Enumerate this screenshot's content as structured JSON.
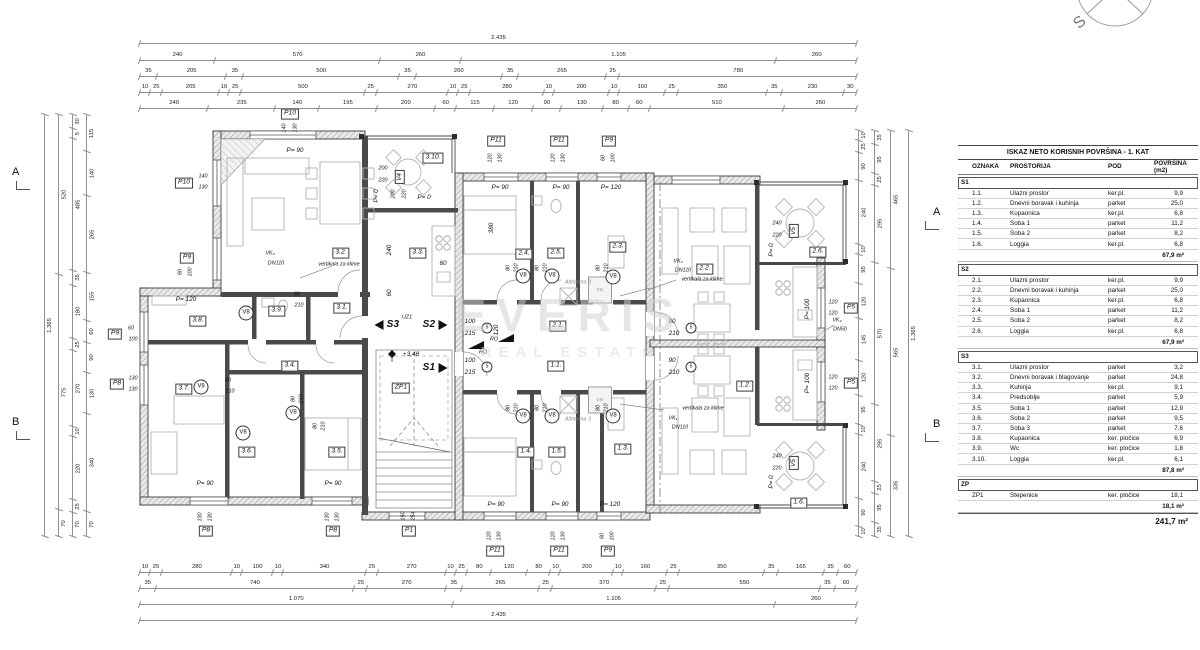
{
  "watermark": {
    "line1": "EVERIS",
    "line2": "REAL ESTATE"
  },
  "compass": {
    "north_letter": "S"
  },
  "section_markers": {
    "a": "A",
    "b": "B"
  },
  "plan": {
    "rooms": {
      "r11": "1.1.",
      "r12": "1.2.",
      "r13": "1.3.",
      "r14": "1.4.",
      "r15": "1.5.",
      "r16": "1.6.",
      "r21": "2.1.",
      "r22": "2.2.",
      "r23": "2.3.",
      "r24": "2.4.",
      "r25": "2.5.",
      "r26": "2.6.",
      "r31": "3.1.",
      "r32": "3.2.",
      "r33": "3.3.",
      "r34": "3.4.",
      "r35": "3.5.",
      "r36": "3.6.",
      "r37": "3.7.",
      "r38": "3.8.",
      "r39": "3.9.",
      "r310": "3.10.",
      "zp1": "ZP1"
    },
    "markers": {
      "p1": "P1",
      "p5": "P5",
      "p8": "P8",
      "p9": "P9",
      "p10": "P10",
      "p11": "P11"
    },
    "v": {
      "v4": "V4",
      "v5": "V5",
      "v8": "V8",
      "c5": "5"
    },
    "doors": {
      "p0": "P= 0",
      "p90": "P= 90",
      "p100": "P= 100",
      "p120": "P= 120"
    },
    "nums": {
      "n60": "60",
      "n80": "80",
      "n90": "90",
      "n100": "100",
      "n115": "115",
      "n120": "120",
      "n130": "130",
      "n140": "140",
      "n150": "150",
      "n200": "200",
      "n210": "210",
      "n215": "215",
      "n220": "220",
      "n240": "240",
      "n254": "254",
      "n380": "380"
    },
    "texts": {
      "vk1": "VK₁",
      "vk2": "VK₂",
      "vk3": "VK₃",
      "vk4": "VK₄",
      "dn110": "DN110",
      "dn50": "DN50",
      "vert": "vertikala za klime",
      "uz1": "UZ1",
      "ro": "RO",
      "level": "+3,48",
      "s1": "S1",
      "s2": "S2",
      "s3": "S3",
      "altherma": "Altherma 3",
      "pr": "PR"
    }
  },
  "dims": {
    "top": [
      [
        "2.435"
      ],
      [
        "240",
        "570",
        "260",
        "1.105",
        "260"
      ],
      [
        "35",
        "205",
        "35",
        "500",
        "35",
        "260",
        "35",
        "265",
        "25",
        "780"
      ],
      [
        "10",
        "25",
        "205",
        "10",
        "25",
        "500",
        "25",
        "270",
        "10",
        "25",
        "280",
        "10",
        "200",
        "10",
        "160",
        "25",
        "350",
        "35",
        "230",
        "30"
      ],
      [
        "240",
        "235",
        "140",
        "195",
        "200",
        "60",
        "115",
        "120",
        "90",
        "130",
        "80",
        "60",
        "510",
        "260"
      ]
    ],
    "bottom": [
      [
        "10",
        "25",
        "280",
        "10",
        "100",
        "10",
        "340",
        "25",
        "270",
        "10",
        "25",
        "80",
        "120",
        "80",
        "10",
        "200",
        "10",
        "160",
        "25",
        "350",
        "35",
        "165",
        "35",
        "60"
      ],
      [
        "35",
        "740",
        "25",
        "270",
        "35",
        "265",
        "25",
        "370",
        "25",
        "550",
        "35",
        "60"
      ],
      [
        "1.070",
        "1.105",
        "260"
      ],
      [
        "2.435"
      ]
    ],
    "left": [
      [
        "1.365"
      ],
      [
        "520",
        "775",
        "70"
      ],
      [
        "30",
        "5",
        "485",
        "35",
        "180",
        "25",
        "270",
        "10",
        "220",
        "25",
        "70"
      ],
      [
        "115",
        "140",
        "265",
        "155",
        "60",
        "90",
        "130",
        "340",
        "70"
      ]
    ],
    "right": [
      [
        "10",
        "25",
        "90",
        "240",
        "10",
        "95",
        "120",
        "145",
        "120",
        "95",
        "10",
        "240",
        "90",
        "10"
      ],
      [
        "35",
        "95",
        "25",
        "295",
        "570",
        "295",
        "25",
        "95",
        "35"
      ],
      [
        "465",
        "565",
        "335"
      ],
      [
        "1.365"
      ]
    ]
  },
  "table": {
    "title": "ISKAZ NETO KORISNIH POVRŠINA - 1. KAT",
    "columns": [
      "",
      "OZNAKA",
      "PROSTORIJA",
      "POD",
      "POVRŠINA (m2)"
    ],
    "sections": [
      {
        "code": "S1",
        "rows": [
          [
            "1.1.",
            "Ulazni prostor",
            "ker.pl.",
            "9,9"
          ],
          [
            "1.2.",
            "Dnevni boravak i kuhinja",
            "parket",
            "25,0"
          ],
          [
            "1.3.",
            "Kupaonica",
            "ker.pl.",
            "6,8"
          ],
          [
            "1.4.",
            "Soba 1",
            "parket",
            "11,2"
          ],
          [
            "1.5.",
            "Soba 2",
            "parket",
            "8,2"
          ],
          [
            "1.6.",
            "Loggia",
            "ker.pl.",
            "6,8"
          ]
        ],
        "subtotal": "67,9 m²"
      },
      {
        "code": "S2",
        "rows": [
          [
            "2.1.",
            "Ulazni prostor",
            "ker.pl.",
            "9,9"
          ],
          [
            "2.2.",
            "Dnevni boravak i kuhinja",
            "parket",
            "25,0"
          ],
          [
            "2.3.",
            "Kupaonica",
            "ker.pl.",
            "6,8"
          ],
          [
            "2.4.",
            "Soba 1",
            "parket",
            "11,2"
          ],
          [
            "2.5.",
            "Soba 2",
            "parket",
            "8,2"
          ],
          [
            "2.6.",
            "Loggia",
            "ker.pl.",
            "6,8"
          ]
        ],
        "subtotal": "67,9 m²"
      },
      {
        "code": "S3",
        "rows": [
          [
            "3.1.",
            "Ulazni prostor",
            "parket",
            "3,2"
          ],
          [
            "3.2.",
            "Dnevni boravak i blagovanje",
            "parket",
            "24,8"
          ],
          [
            "3.3.",
            "Kuhinja",
            "ker.pl.",
            "9,1"
          ],
          [
            "3.4.",
            "Predsoblje",
            "parket",
            "5,9"
          ],
          [
            "3.5.",
            "Soba 1",
            "parket",
            "12,9"
          ],
          [
            "3.6.",
            "Soba 2",
            "parket",
            "9,5"
          ],
          [
            "3.7.",
            "Soba 3",
            "parket",
            "7,6"
          ],
          [
            "3.8.",
            "Kupaonica",
            "ker. pločice",
            "6,9"
          ],
          [
            "3.9.",
            "Wc",
            "ker. pločice",
            "1,8"
          ],
          [
            "3.10.",
            "Loggia",
            "ker.pl.",
            "6,1"
          ]
        ],
        "subtotal": "87,8 m²"
      },
      {
        "code": "ZP",
        "rows": [
          [
            "ZP1",
            "Stepenice",
            "ker. pločice",
            "18,1"
          ]
        ],
        "subtotal": "18,1 m²"
      }
    ],
    "total": "241,7 m²"
  }
}
